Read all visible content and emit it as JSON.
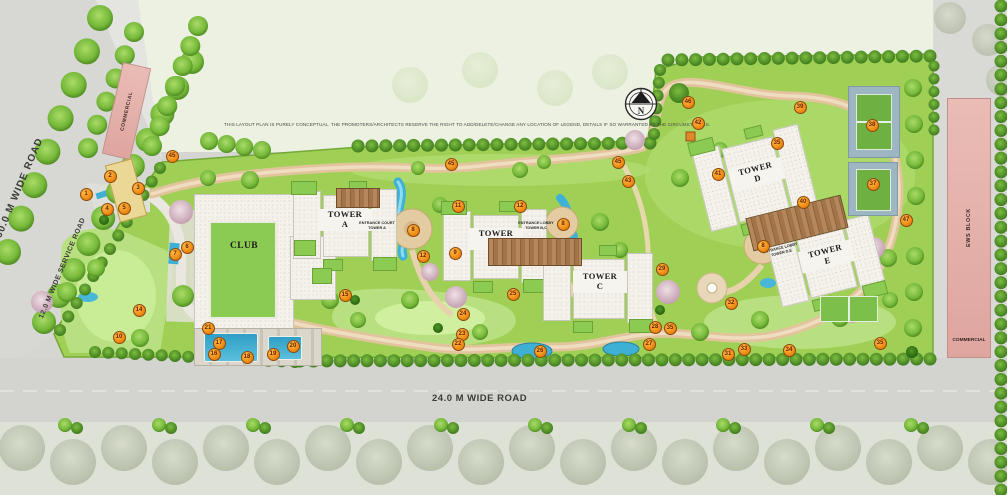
{
  "disclaimer": "THIS LAYOUT PLAN IS PURELY CONCEPTUAL. THE PROMOTERS/ARCHITECTS RESERVE THE RIGHT TO ADD/DELETE/CHANGE ANY LOCATION OF LEGEND, DETAILS IF SO WARRANTED BY THE CIRCUMSTANCES.",
  "north": {
    "letter": "N"
  },
  "roads": {
    "left_road": "60.0 M WIDE ROAD",
    "service_road": "12.0 M WIDE SERVICE ROAD",
    "bottom_road": "24.0 M WIDE ROAD"
  },
  "buildings": {
    "commercial_top": "COMMERCIAL",
    "ews_block": "EWS BLOCK",
    "ews_commercial": "COMMERCIAL",
    "club": "CLUB",
    "towers": [
      {
        "label": "TOWER\nA"
      },
      {
        "label": "TOWER\nB"
      },
      {
        "label": "TOWER\nC"
      },
      {
        "label": "TOWER\nD"
      },
      {
        "label": "TOWER\nE"
      }
    ],
    "entrance_court_a": "ENTRANCE COURT\nTOWER A",
    "entrance_lobby_bc": "ENTRANCE LOBBY\nTOWER B,C",
    "entrance_lobby_de": "ENTRANCE LOBBY\nTOWER D,E"
  },
  "markers": [
    {
      "n": "45",
      "x": 171,
      "y": 155
    },
    {
      "n": "1",
      "x": 85,
      "y": 193
    },
    {
      "n": "2",
      "x": 109,
      "y": 175
    },
    {
      "n": "3",
      "x": 137,
      "y": 187
    },
    {
      "n": "4",
      "x": 106,
      "y": 208
    },
    {
      "n": "5",
      "x": 123,
      "y": 207
    },
    {
      "n": "6",
      "x": 186,
      "y": 246
    },
    {
      "n": "7",
      "x": 174,
      "y": 253
    },
    {
      "n": "14",
      "x": 138,
      "y": 309
    },
    {
      "n": "10",
      "x": 118,
      "y": 336
    },
    {
      "n": "21",
      "x": 207,
      "y": 327
    },
    {
      "n": "17",
      "x": 218,
      "y": 342
    },
    {
      "n": "16",
      "x": 213,
      "y": 353
    },
    {
      "n": "18",
      "x": 246,
      "y": 356
    },
    {
      "n": "19",
      "x": 272,
      "y": 353
    },
    {
      "n": "20",
      "x": 292,
      "y": 345
    },
    {
      "n": "15",
      "x": 344,
      "y": 294
    },
    {
      "n": "8",
      "x": 412,
      "y": 229
    },
    {
      "n": "11",
      "x": 457,
      "y": 205
    },
    {
      "n": "12",
      "x": 422,
      "y": 255
    },
    {
      "n": "9",
      "x": 454,
      "y": 252
    },
    {
      "n": "12",
      "x": 519,
      "y": 205
    },
    {
      "n": "8",
      "x": 562,
      "y": 223
    },
    {
      "n": "25",
      "x": 512,
      "y": 293
    },
    {
      "n": "24",
      "x": 462,
      "y": 313
    },
    {
      "n": "23",
      "x": 461,
      "y": 333
    },
    {
      "n": "22",
      "x": 457,
      "y": 343
    },
    {
      "n": "26",
      "x": 539,
      "y": 350
    },
    {
      "n": "27",
      "x": 648,
      "y": 343
    },
    {
      "n": "28",
      "x": 654,
      "y": 326
    },
    {
      "n": "35",
      "x": 669,
      "y": 327
    },
    {
      "n": "29",
      "x": 661,
      "y": 268
    },
    {
      "n": "45",
      "x": 450,
      "y": 163
    },
    {
      "n": "45",
      "x": 617,
      "y": 161
    },
    {
      "n": "43",
      "x": 627,
      "y": 180
    },
    {
      "n": "46",
      "x": 687,
      "y": 101
    },
    {
      "n": "42",
      "x": 697,
      "y": 122
    },
    {
      "n": "39",
      "x": 799,
      "y": 106
    },
    {
      "n": "35",
      "x": 776,
      "y": 142
    },
    {
      "n": "41",
      "x": 717,
      "y": 173
    },
    {
      "n": "40",
      "x": 802,
      "y": 201
    },
    {
      "n": "38",
      "x": 871,
      "y": 124
    },
    {
      "n": "37",
      "x": 872,
      "y": 183
    },
    {
      "n": "8",
      "x": 762,
      "y": 245
    },
    {
      "n": "32",
      "x": 730,
      "y": 302
    },
    {
      "n": "31",
      "x": 727,
      "y": 353
    },
    {
      "n": "33",
      "x": 743,
      "y": 348
    },
    {
      "n": "34",
      "x": 788,
      "y": 349
    },
    {
      "n": "35",
      "x": 879,
      "y": 342
    },
    {
      "n": "47",
      "x": 905,
      "y": 219
    }
  ],
  "colors": {
    "site_green": "#9fd055",
    "lawn_light": "#b9e080",
    "water": "#3fb0d6",
    "path_tan": "#e2c49c",
    "building_pink": "#e6b3ae",
    "marker_orange": "#ef8c14",
    "road_grey": "#d5d5d1"
  }
}
